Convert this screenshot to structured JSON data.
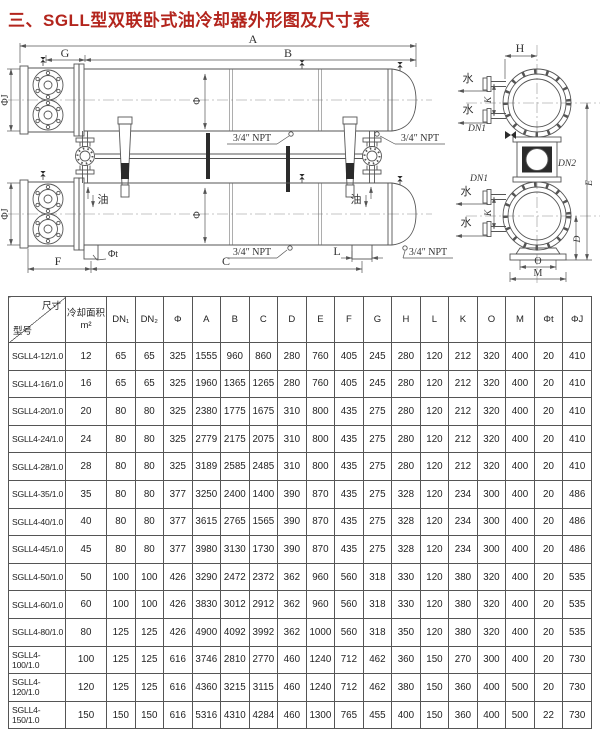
{
  "title": "三、SGLL型双联卧式油冷却器外形图及尺寸表",
  "colors": {
    "title": "#b3251d",
    "line": "#555555",
    "table_border": "#555555"
  },
  "drawing": {
    "labels": {
      "a": "A",
      "b": "B",
      "g": "G",
      "c": "C",
      "f": "F",
      "l": "L",
      "h": "H",
      "k": "K",
      "d": "D",
      "e": "E",
      "o": "O",
      "m": "M",
      "phi": "Φ",
      "phi_j": "ΦJ",
      "phi_t": "Φt",
      "dn1": "DN1",
      "dn2": "DN2",
      "water": "水",
      "oil": "油",
      "npt": "3/4″ NPT"
    }
  },
  "table": {
    "corner_top": "尺寸",
    "corner_bottom": "型号",
    "headers": [
      "冷却面积\nm²",
      "DN₁",
      "DN₂",
      "Φ",
      "A",
      "B",
      "C",
      "D",
      "E",
      "F",
      "G",
      "H",
      "L",
      "K",
      "O",
      "M",
      "Φt",
      "ΦJ"
    ],
    "rows": [
      [
        "SGLL4-12/1.0",
        "12",
        "65",
        "65",
        "325",
        "1555",
        "960",
        "860",
        "280",
        "760",
        "405",
        "245",
        "280",
        "120",
        "212",
        "320",
        "400",
        "20",
        "410"
      ],
      [
        "SGLL4-16/1.0",
        "16",
        "65",
        "65",
        "325",
        "1960",
        "1365",
        "1265",
        "280",
        "760",
        "405",
        "245",
        "280",
        "120",
        "212",
        "320",
        "400",
        "20",
        "410"
      ],
      [
        "SGLL4-20/1.0",
        "20",
        "80",
        "80",
        "325",
        "2380",
        "1775",
        "1675",
        "310",
        "800",
        "435",
        "275",
        "280",
        "120",
        "212",
        "320",
        "400",
        "20",
        "410"
      ],
      [
        "SGLL4-24/1.0",
        "24",
        "80",
        "80",
        "325",
        "2779",
        "2175",
        "2075",
        "310",
        "800",
        "435",
        "275",
        "280",
        "120",
        "212",
        "320",
        "400",
        "20",
        "410"
      ],
      [
        "SGLL4-28/1.0",
        "28",
        "80",
        "80",
        "325",
        "3189",
        "2585",
        "2485",
        "310",
        "800",
        "435",
        "275",
        "280",
        "120",
        "212",
        "320",
        "400",
        "20",
        "410"
      ],
      [
        "SGLL4-35/1.0",
        "35",
        "80",
        "80",
        "377",
        "3250",
        "2400",
        "1400",
        "390",
        "870",
        "435",
        "275",
        "328",
        "120",
        "234",
        "300",
        "400",
        "20",
        "486"
      ],
      [
        "SGLL4-40/1.0",
        "40",
        "80",
        "80",
        "377",
        "3615",
        "2765",
        "1565",
        "390",
        "870",
        "435",
        "275",
        "328",
        "120",
        "234",
        "300",
        "400",
        "20",
        "486"
      ],
      [
        "SGLL4-45/1.0",
        "45",
        "80",
        "80",
        "377",
        "3980",
        "3130",
        "1730",
        "390",
        "870",
        "435",
        "275",
        "328",
        "120",
        "234",
        "300",
        "400",
        "20",
        "486"
      ],
      [
        "SGLL4-50/1.0",
        "50",
        "100",
        "100",
        "426",
        "3290",
        "2472",
        "2372",
        "362",
        "960",
        "560",
        "318",
        "330",
        "120",
        "380",
        "320",
        "400",
        "20",
        "535"
      ],
      [
        "SGLL4-60/1.0",
        "60",
        "100",
        "100",
        "426",
        "3830",
        "3012",
        "2912",
        "362",
        "960",
        "560",
        "318",
        "330",
        "120",
        "380",
        "320",
        "400",
        "20",
        "535"
      ],
      [
        "SGLL4-80/1.0",
        "80",
        "125",
        "125",
        "426",
        "4900",
        "4092",
        "3992",
        "362",
        "1000",
        "560",
        "318",
        "350",
        "120",
        "380",
        "320",
        "400",
        "20",
        "535"
      ],
      [
        "SGLL4-100/1.0",
        "100",
        "125",
        "125",
        "616",
        "3746",
        "2810",
        "2770",
        "460",
        "1240",
        "712",
        "462",
        "360",
        "150",
        "270",
        "300",
        "400",
        "20",
        "730"
      ],
      [
        "SGLL4-120/1.0",
        "120",
        "125",
        "125",
        "616",
        "4360",
        "3215",
        "3115",
        "460",
        "1240",
        "712",
        "462",
        "380",
        "150",
        "360",
        "400",
        "500",
        "20",
        "730"
      ],
      [
        "SGLL4-150/1.0",
        "150",
        "150",
        "150",
        "616",
        "5316",
        "4310",
        "4284",
        "460",
        "1300",
        "765",
        "455",
        "400",
        "150",
        "360",
        "400",
        "500",
        "22",
        "730"
      ]
    ]
  }
}
